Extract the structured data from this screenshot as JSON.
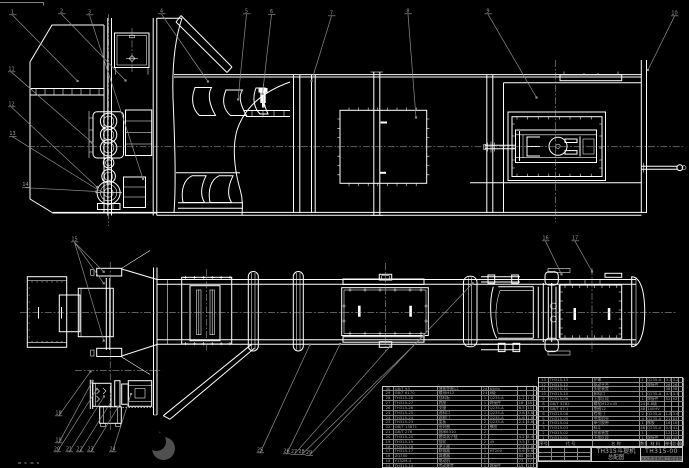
{
  "title_block": {
    "product_name_line1": "TH315斗提机",
    "product_name_line2": "总配图",
    "drawing_number": "TH315-00",
    "org_line": "××大学机械工程学院"
  },
  "bom": {
    "headers": [
      "序号",
      "代 号",
      "名 称",
      "数量",
      "材 料",
      "单件",
      "总计",
      "备注"
    ],
    "right_rows": [
      [
        "13",
        "TH315-13",
        "护罩",
        "1",
        "Q235-A",
        "3.2",
        "3.2",
        ""
      ],
      [
        "12",
        "TH315-12",
        "驱动平台",
        "1",
        "焊接件",
        "26",
        "26",
        ""
      ],
      [
        "11",
        "TH315-11",
        "头轮装置",
        "1",
        "",
        "38",
        "38",
        ""
      ],
      [
        "10",
        "TH315-10",
        "卸料口",
        "1",
        "Q235-A",
        "4.5",
        "4.5",
        ""
      ],
      [
        "9",
        "TH315-09",
        "上部区段",
        "1",
        "焊接件",
        "52",
        "52",
        ""
      ],
      [
        "8",
        "GB/T 5782",
        "螺栓M12×45",
        "24",
        "8.8级",
        "",
        "",
        ""
      ],
      [
        "7",
        "GB/T 97.1",
        "垫圈12",
        "48",
        "140HV",
        "",
        "",
        ""
      ],
      [
        "6",
        "TH315-06",
        "检视门",
        "2",
        "Q235-A",
        "1.8",
        "3.6",
        ""
      ],
      [
        "5",
        "TH315-05",
        "中部机壳",
        "4",
        "Q235-A",
        "21",
        "84",
        ""
      ],
      [
        "4",
        "TH315-04",
        "牵引胶带",
        "1",
        "橡胶",
        "16",
        "16",
        ""
      ],
      [
        "3",
        "TH315-03",
        "料斗",
        "46",
        "Q235-A",
        "0.9",
        "41.4",
        ""
      ],
      [
        "2",
        "TH315-02",
        "张紧装置",
        "1",
        "",
        "12",
        "12",
        ""
      ],
      [
        "1",
        "TH315-01",
        "下部区段",
        "1",
        "焊接件",
        "45",
        "45",
        ""
      ]
    ],
    "left_rows": [
      [
        "30",
        "GB/T 93",
        "弹簧垫圈12",
        "24",
        "65Mn",
        "",
        "",
        ""
      ],
      [
        "29",
        "GB/T 6170",
        "螺母M12",
        "24",
        "8级",
        "",
        "",
        ""
      ],
      [
        "28",
        "TH315-28",
        "挡料板",
        "1",
        "Q235-A",
        "1.2",
        "1.2",
        ""
      ],
      [
        "27",
        "TH315-27",
        "底座",
        "1",
        "焊接件",
        "18",
        "18",
        ""
      ],
      [
        "26",
        "TH315-26",
        "支腿",
        "2",
        "Q235-A",
        "6.5",
        "13",
        ""
      ],
      [
        "25",
        "TH315-25",
        "进料口",
        "1",
        "Q235-A",
        "3.8",
        "3.8",
        ""
      ],
      [
        "24",
        "TH315-24",
        "观察门",
        "1",
        "Q235-A",
        "1.6",
        "1.6",
        ""
      ],
      [
        "23",
        "TH315-23",
        "盖板",
        "2",
        "Q235-A",
        "2.4",
        "4.8",
        ""
      ],
      [
        "22",
        "GB/T 13871",
        "密封圈",
        "2",
        "橡胶",
        "",
        "",
        ""
      ],
      [
        "21",
        "GB/T 276",
        "轴承6310",
        "2",
        "",
        "",
        "",
        ""
      ],
      [
        "20",
        "TH315-20",
        "套筒滚子链",
        "2",
        "",
        "4.2",
        "8.4",
        ""
      ],
      [
        "19",
        "TH315-19",
        "链轮",
        "2",
        "45",
        "3.5",
        "7",
        ""
      ],
      [
        "18",
        "TH315-18",
        "逆止器",
        "1",
        "",
        "2.8",
        "2.8",
        ""
      ],
      [
        "17",
        "TH315-17",
        "联轴器",
        "1",
        "HT200",
        "5.6",
        "5.6",
        ""
      ],
      [
        "16",
        "ZQ350",
        "减速器",
        "1",
        "",
        "65",
        "65",
        ""
      ],
      [
        "15",
        "Y132M-4",
        "电动机",
        "1",
        "",
        "77",
        "77",
        ""
      ],
      [
        "14",
        "TH315-14",
        "传动装置",
        "1",
        "焊接件",
        "15",
        "15",
        ""
      ]
    ]
  },
  "balloons": [
    {
      "label": "1",
      "x": 10,
      "y": 9,
      "leaders": [
        [
          77.5,
          81
        ]
      ]
    },
    {
      "label": "2",
      "x": 59,
      "y": 8,
      "leaders": [
        [
          125.5,
          80.5
        ]
      ]
    },
    {
      "label": "3",
      "x": 87,
      "y": 9,
      "leaders": [
        [
          143,
          179
        ]
      ]
    },
    {
      "label": "4",
      "x": 159,
      "y": 8,
      "leaders": [
        [
          208,
          81.5
        ]
      ]
    },
    {
      "label": "5",
      "x": 244,
      "y": 8,
      "leaders": [
        [
          238,
          99.5
        ]
      ]
    },
    {
      "label": "6",
      "x": 269,
      "y": 8.5,
      "leaders": [
        [
          262.5,
          94
        ]
      ]
    },
    {
      "label": "7",
      "x": 329,
      "y": 10,
      "leaders": [
        [
          311.5,
          81
        ]
      ]
    },
    {
      "label": "8",
      "x": 405.5,
      "y": 8,
      "leaders": [
        [
          416,
          117.5
        ]
      ]
    },
    {
      "label": "9",
      "x": 485.5,
      "y": 8,
      "leaders": [
        [
          536.5,
          97.5
        ]
      ]
    },
    {
      "label": "10",
      "x": 672,
      "y": 10,
      "leaders": [
        [
          648,
          70
        ]
      ]
    },
    {
      "label": "11",
      "x": 9,
      "y": 66,
      "leaders": [
        [
          92.5,
          143
        ]
      ]
    },
    {
      "label": "12",
      "x": 9,
      "y": 101,
      "leaders": [
        [
          97,
          187
        ]
      ]
    },
    {
      "label": "13",
      "x": 10,
      "y": 130.5,
      "leaders": [
        [
          101.5,
          192
        ]
      ]
    },
    {
      "label": "14",
      "x": 23,
      "y": 181.5,
      "leaders": [
        [
          96.5,
          191.5
        ]
      ]
    },
    {
      "label": "15",
      "x": 72,
      "y": 236,
      "leaders": [
        [
          103.7,
          271.7
        ],
        [
          103.7,
          283.3
        ],
        [
          103.7,
          340.7
        ]
      ]
    },
    {
      "label": "16",
      "x": 543,
      "y": 235,
      "leaders": [
        [
          561.5,
          274.3
        ]
      ]
    },
    {
      "label": "17",
      "x": 572.5,
      "y": 235,
      "leaders": [
        [
          592,
          271.5
        ]
      ]
    },
    {
      "label": "18",
      "x": 56,
      "y": 410,
      "leaders": [
        [
          90.5,
          371.5
        ]
      ]
    },
    {
      "label": "19",
      "x": 56,
      "y": 437,
      "leaders": [
        [
          92.5,
          381
        ]
      ]
    },
    {
      "label": "20",
      "x": 54.5,
      "y": 446,
      "leaders": [
        [
          97,
          389
        ]
      ]
    },
    {
      "label": "21",
      "x": 66.5,
      "y": 446,
      "leaders": [
        [
          104,
          396.5
        ]
      ]
    },
    {
      "label": "22",
      "x": 77,
      "y": 446,
      "leaders": [
        [
          111,
          402
        ]
      ]
    },
    {
      "label": "23",
      "x": 88,
      "y": 446,
      "leaders": [
        [
          118,
          407
        ]
      ]
    },
    {
      "label": "24",
      "x": 110,
      "y": 446,
      "leaders": [
        [
          131,
          394
        ]
      ]
    },
    {
      "label": "25",
      "x": 257.5,
      "y": 447,
      "leaders": [
        [
          310,
          344.5
        ]
      ]
    },
    {
      "label": "26",
      "x": 284,
      "y": 448,
      "leaders": [
        [
          340,
          344
        ]
      ]
    },
    {
      "label": "27",
      "x": 291.5,
      "y": 448.5,
      "leaders": [
        [
          390,
          346.5
        ]
      ]
    },
    {
      "label": "28",
      "x": 299,
      "y": 448.5,
      "leaders": [
        [
          424,
          335.5
        ]
      ]
    },
    {
      "label": "29",
      "x": 306.5,
      "y": 449.5,
      "leaders": [
        [
          472.7,
          283.3
        ]
      ]
    }
  ],
  "colors": {
    "background": "#000000",
    "line": "#ffffff",
    "annotation": "#8e8e8e",
    "table_text": "#a8a8a8",
    "org_highlight": "#6f6f6f"
  }
}
